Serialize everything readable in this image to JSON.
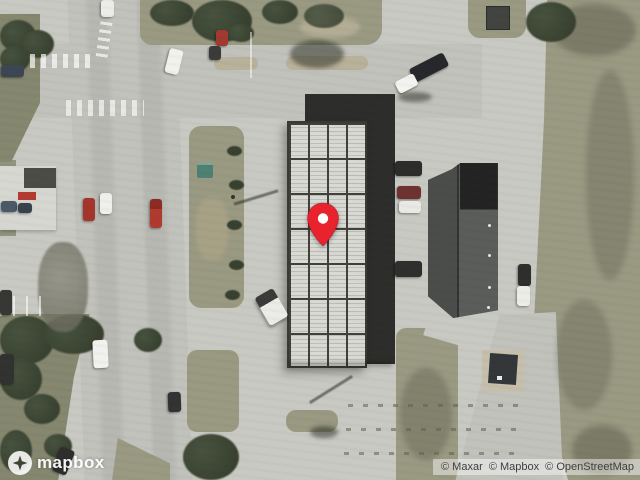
{
  "map": {
    "marker": {
      "icon": "location-pin-icon"
    }
  },
  "branding": {
    "logo_text": "mapbox",
    "logo_icon": "mapbox-logo-icon"
  },
  "attribution": {
    "items": [
      {
        "label": "© Maxar"
      },
      {
        "label": "© Mapbox"
      },
      {
        "label": "© OpenStreetMap"
      }
    ]
  },
  "palette": {
    "concrete": "#c8c9c3",
    "road": "#c1c2bc",
    "grass": "#9a9a83",
    "grass-dark": "#85876f",
    "dirt": "#b9b19a",
    "tree": "#47523f",
    "tree-dark": "#38412f",
    "roof-grid": "#d9dad4",
    "roof-grid-line": "#41413c",
    "roof-dark": "#2d2e2b",
    "roof-right-west": "#4a4d4a",
    "roof-right-east": "#5a5d5a",
    "roof-right-top": "#232423",
    "teal": "#4e8074",
    "pin-red": "#e8232e",
    "pin-dot": "#ffffff",
    "attribution-text": "#3f3f3f"
  }
}
